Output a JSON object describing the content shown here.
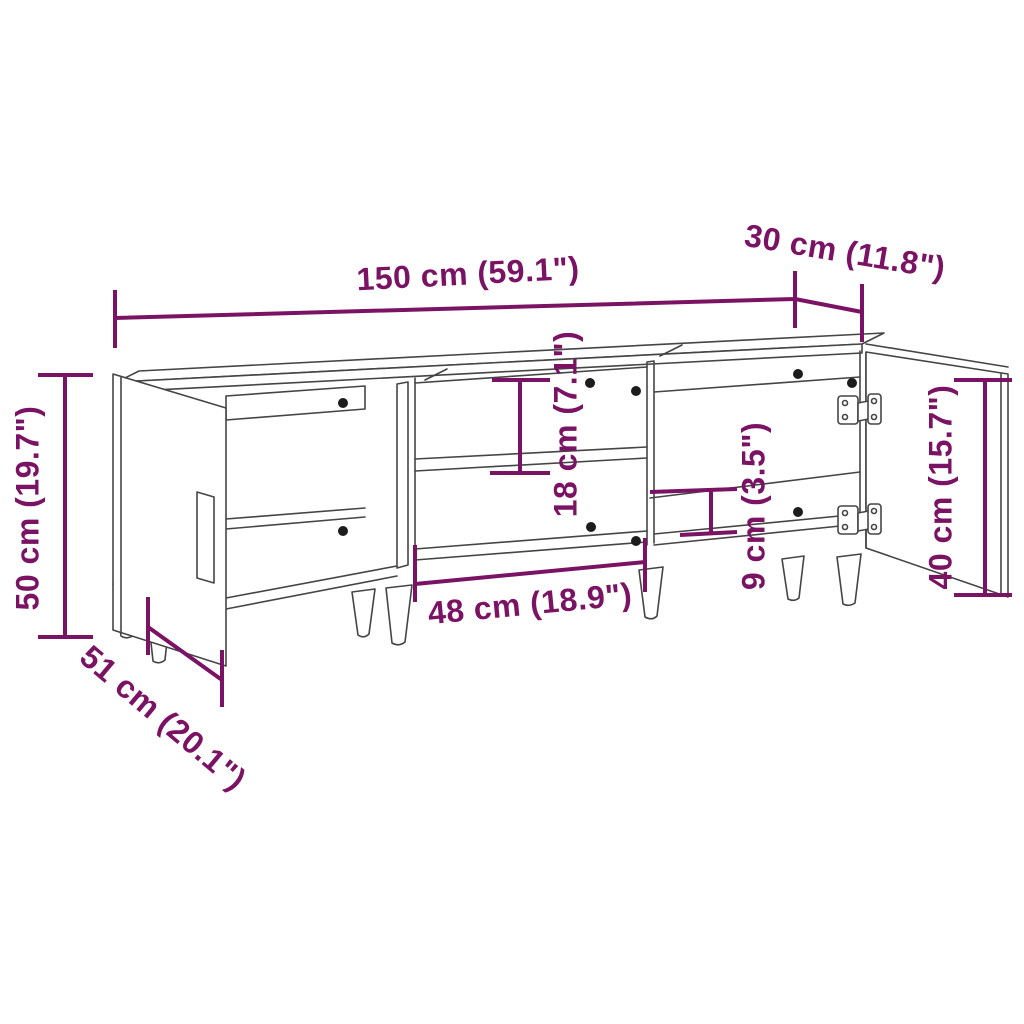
{
  "diagram": {
    "type": "furniture-dimension-diagram",
    "product": "TV cabinet with two open doors, middle shelf compartment and tapered legs",
    "background_color": "#ffffff",
    "line_color": "#454545",
    "accent_color": "#7b1365",
    "units": [
      "cm",
      "inch"
    ]
  },
  "dims": {
    "overall_width": {
      "label": "150 cm (59.1\")",
      "value_cm": 150,
      "value_in": 59.1
    },
    "top_depth": {
      "label": "30 cm (11.8\")",
      "value_cm": 30,
      "value_in": 11.8
    },
    "overall_height": {
      "label": "50 cm (19.7\")",
      "value_cm": 50,
      "value_in": 19.7
    },
    "side_depth": {
      "label": "51 cm (20.1\")",
      "value_cm": 51,
      "value_in": 20.1
    },
    "shelf_opening_height": {
      "label": "18 cm (7.1\")",
      "value_cm": 18,
      "value_in": 7.1
    },
    "middle_compartment_width": {
      "label": "48 cm (18.9\")",
      "value_cm": 48,
      "value_in": 18.9
    },
    "plinth_height": {
      "label": "9 cm (3.5\")",
      "value_cm": 9,
      "value_in": 3.5
    },
    "door_panel_height": {
      "label": "40 cm (15.7\")",
      "value_cm": 40,
      "value_in": 15.7
    }
  }
}
